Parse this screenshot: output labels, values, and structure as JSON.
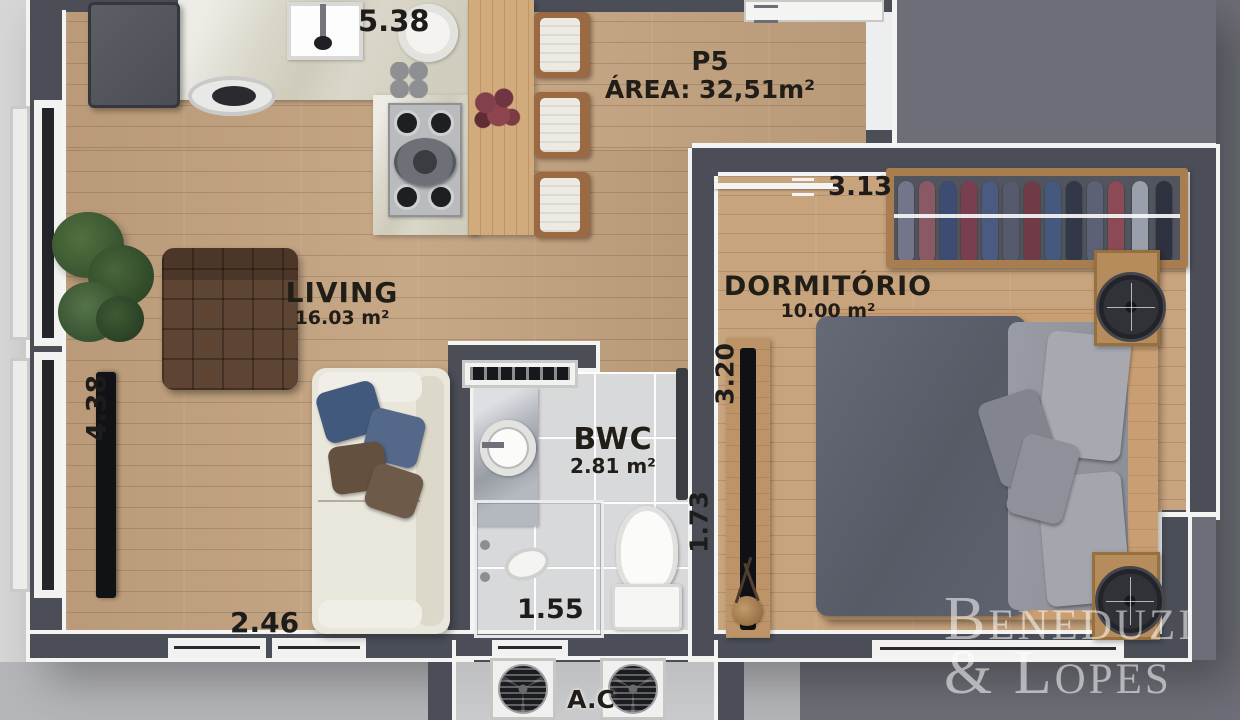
{
  "unit": {
    "code": "P5",
    "area_label": "ÁREA: 32,51m²"
  },
  "rooms": {
    "living": {
      "name": "LIVING",
      "area": "16.03 m²"
    },
    "dormitorio": {
      "name": "DORMITÓRIO",
      "area": "10.00 m²"
    },
    "bwc": {
      "name": "BWC",
      "area": "2.81 m²"
    },
    "ac": {
      "name": "A.C"
    }
  },
  "dimensions": {
    "kitchen_top": "5.38",
    "dorm_width": "3.13",
    "living_height": "4.38",
    "dorm_height": "3.20",
    "bwc_height": "1.73",
    "bwc_width": "1.55",
    "living_width": "2.46"
  },
  "watermark": {
    "line1": "Beneduzi",
    "line2": "& Lopes"
  },
  "colors": {
    "wall": "#4b4e57",
    "trim": "#f4f4f2",
    "wood_floor": "#c3a27f",
    "tile_floor": "#d8d9db",
    "background": "#6d6e77",
    "background_light": "#b5b6ba"
  }
}
